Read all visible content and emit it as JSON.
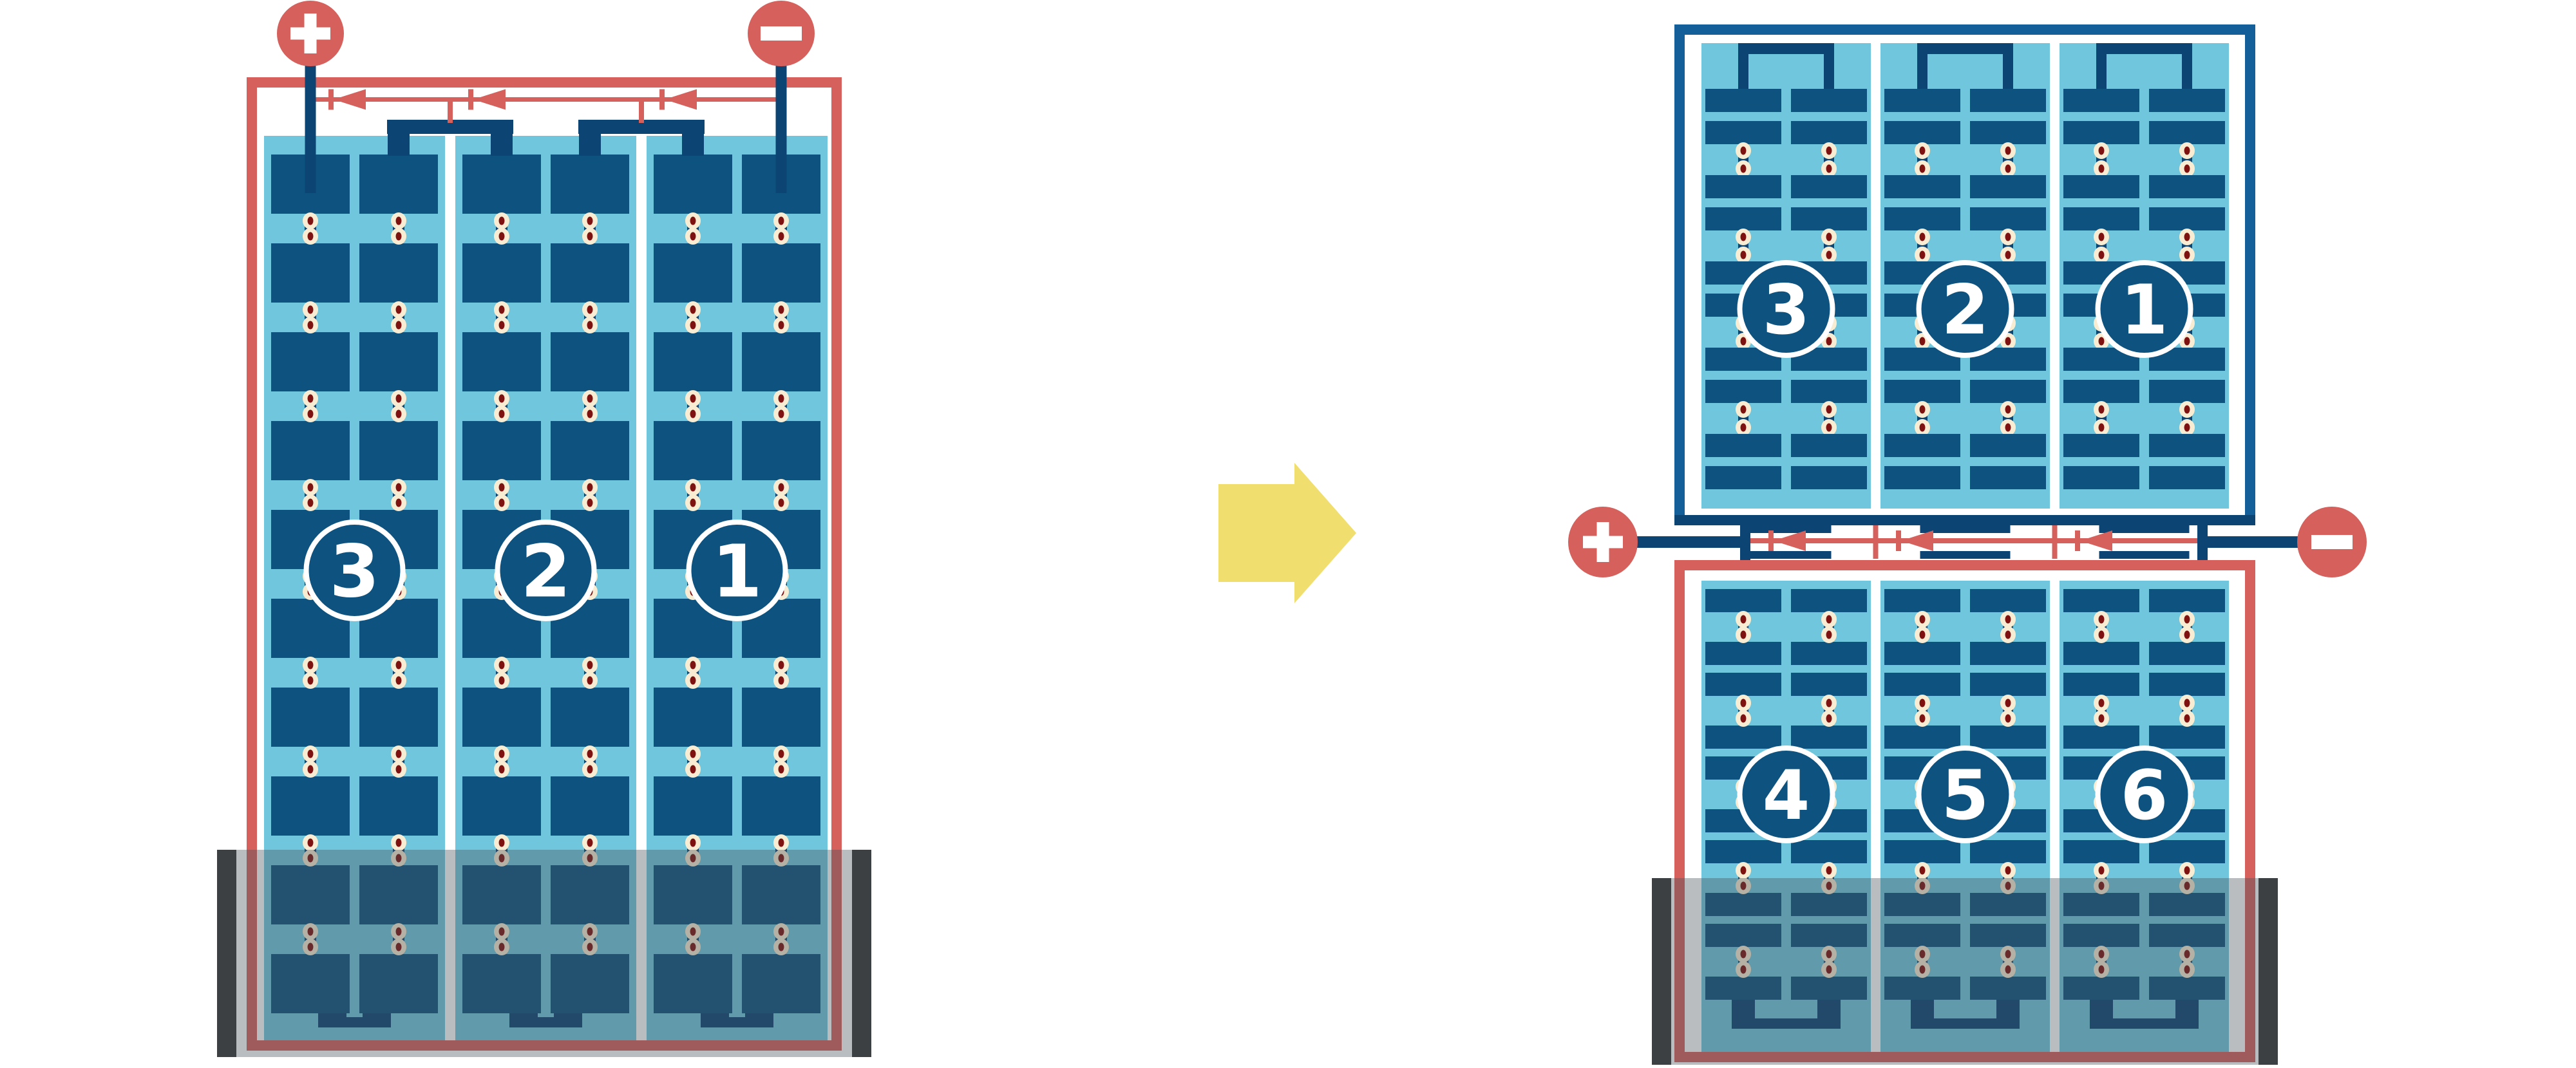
{
  "colors": {
    "red": "#D5605C",
    "wire_navy": "#0C4573",
    "cell_blue": "#0E527F",
    "light_blue": "#70C7DD",
    "frame_blue": "#145E99",
    "dot_cream": "#F8EDD3",
    "dot_core": "#7E1210",
    "arrow_yellow": "#F0DF6E",
    "shade_gray": "#46525A",
    "shade_opacity": 0.38,
    "shade_end_bar": "#3C4043",
    "badge_fill": "#0E527F",
    "badge_stroke": "#FFFFFF",
    "badge_text": "#FFFFFF",
    "terminal_glyph": "#FFFFFF",
    "background": "#FFFFFF"
  },
  "left_module": {
    "terminals": {
      "positive": "+",
      "negative": "−"
    },
    "strings": [
      {
        "label": "3"
      },
      {
        "label": "2"
      },
      {
        "label": "1"
      }
    ],
    "cell_rows": 10,
    "cell_columns_per_string": 2,
    "bypass_diodes": 3,
    "shaded_bottom": true
  },
  "right_module": {
    "terminals": {
      "positive": "+",
      "negative": "−"
    },
    "top_half": {
      "strings": [
        {
          "label": "3"
        },
        {
          "label": "2"
        },
        {
          "label": "1"
        }
      ],
      "cell_rows": 10
    },
    "bottom_half": {
      "strings": [
        {
          "label": "4"
        },
        {
          "label": "5"
        },
        {
          "label": "6"
        }
      ],
      "cell_rows": 10
    },
    "bypass_diodes": 3,
    "shaded_bottom": true
  },
  "transition_arrow": {
    "direction": "right"
  }
}
